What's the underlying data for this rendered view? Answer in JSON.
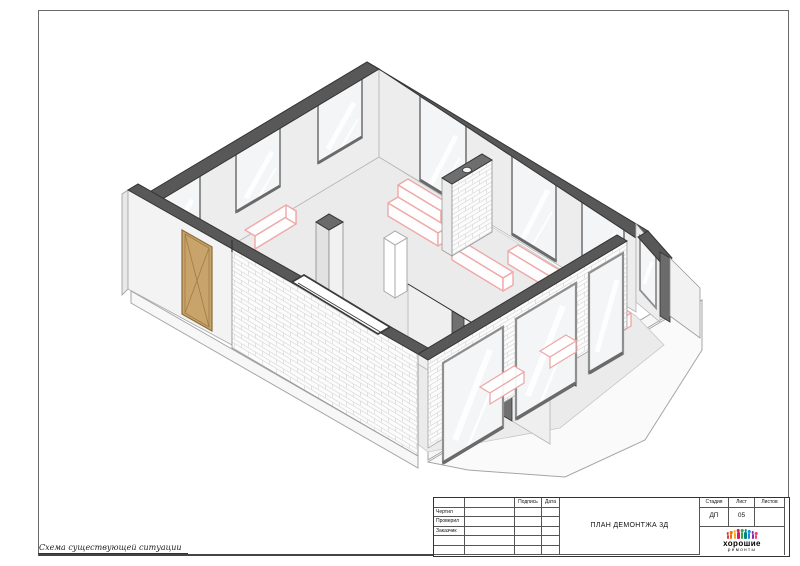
{
  "sheet": {
    "footer_note": "Схема существующей ситуации"
  },
  "title_block": {
    "signature_label": "Подпись",
    "date_label": "Дата",
    "rows": [
      {
        "label": "Чертил"
      },
      {
        "label": "Проверил"
      },
      {
        "label": "Заказчик"
      }
    ],
    "doc_title": "ПЛАН ДЕМОНТЖА 3Д",
    "stage_label": "Стадия",
    "sheet_label": "Лист",
    "sheets_label": "Листов",
    "stage_value": "ДП",
    "sheet_value": "05",
    "sheets_value": ""
  },
  "logo": {
    "line1": "хорошие",
    "line2": "ремонты",
    "mark_colors": [
      "#e53935",
      "#ef6c00",
      "#f9a825",
      "#d81b60",
      "#43a047",
      "#00897b",
      "#1e88e5",
      "#8e24aa",
      "#ec407a"
    ],
    "mark_heights": [
      4,
      5,
      6,
      7,
      7,
      7,
      6,
      5,
      4
    ]
  },
  "drawing": {
    "type": "axonometric-demolition-plan",
    "colors": {
      "wall_cut_cap": "#585858",
      "interior_wall": "#ededed",
      "floor": "#ebebeb",
      "glass": "#f3f5f6",
      "window_frame": "#8f8f8f",
      "demolition_highlight": "#efa9a9",
      "door_wood": "#c9a46a",
      "brick_mortar": "#d6d6d6",
      "slab": "#fafafa"
    },
    "elements": [
      "perimeter-walls",
      "windows",
      "entrance-door",
      "brick-walls",
      "ventilation-pier",
      "free-standing-column",
      "duct-outline",
      "partition-with-opening",
      "bay-windows",
      "demolition-highlights",
      "floor-slab"
    ]
  }
}
